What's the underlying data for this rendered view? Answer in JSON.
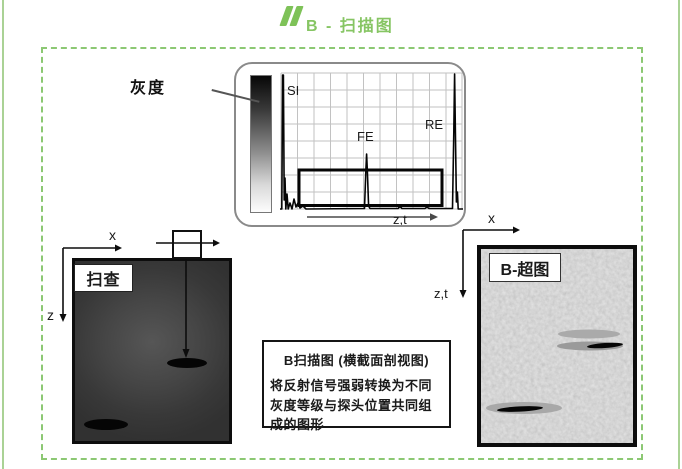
{
  "page": {
    "title": "B - 扫描图"
  },
  "ascan_panel": {
    "grayscale_label": "灰度",
    "peak_si": "SI",
    "peak_fe": "FE",
    "peak_re": "RE",
    "axis_zt": "z,t"
  },
  "specimen": {
    "label": "扫查",
    "axis_x": "x",
    "axis_z": "z"
  },
  "bscan": {
    "label": "B-超图",
    "axis_x": "x",
    "axis_zt": "z,t"
  },
  "caption": {
    "title": "B扫描图 (横截面剖视图)",
    "body": "将反射信号强弱转换为不同灰度等级与探头位置共同组成的图形"
  },
  "colors": {
    "accent_green": "#86c563",
    "dashed_border_green": "#8cc873",
    "side_line_green": "#aad295",
    "specimen_gray": "#3a3a3a",
    "bscan_gray": "#c9c9c9"
  }
}
